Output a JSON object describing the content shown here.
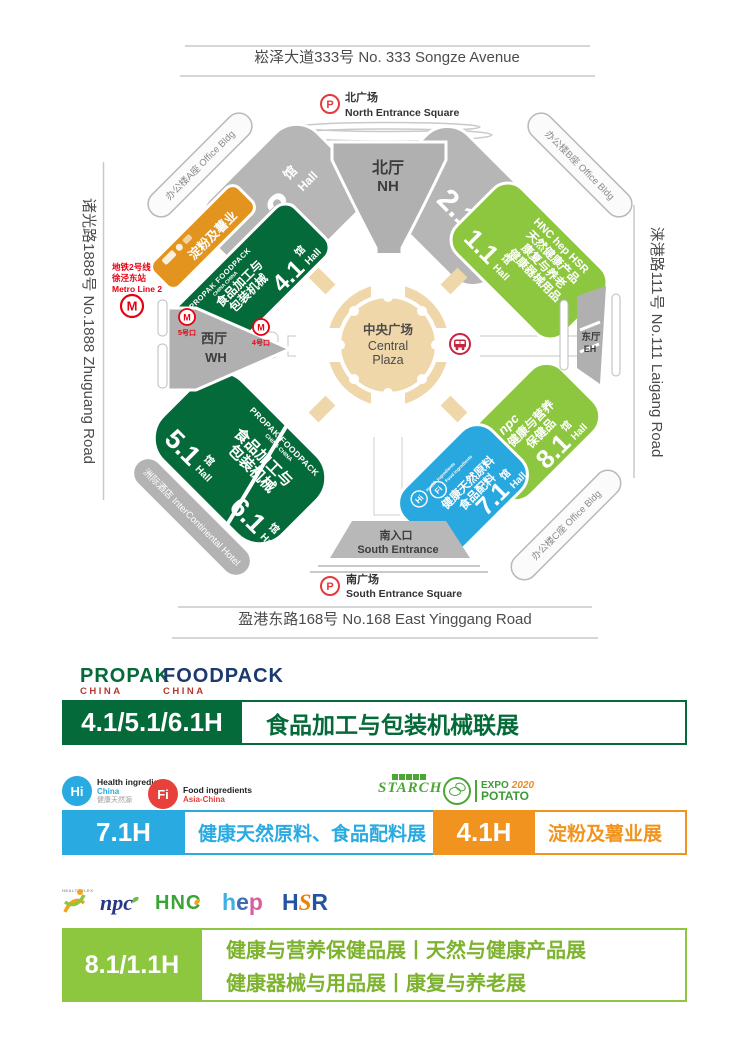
{
  "colors": {
    "dark_green": "#056a39",
    "light_green": "#8dc63f",
    "blue": "#29a8e0",
    "orange_map": "#e2941f",
    "orange_bar": "#f0941f",
    "gray_hall": "#b6b6b6",
    "tan_plaza": "#f0d7a9",
    "metro_red": "#e60012",
    "china_red": "#b5382f",
    "foodpack_navy": "#1d3a6e",
    "bar4_text_green": "#7db32e"
  },
  "roads": {
    "north": "崧泽大道333号  No. 333 Songze Avenue",
    "west": "诸光路1888号  No.1888 Zhuguang Road",
    "east": "涞港路111号  No.111 Laigang Road",
    "south": "盈港东路168号  No.168 East Yinggang Road"
  },
  "p_label": "P",
  "north_square": {
    "cn": "北广场",
    "en": "North Entrance Square"
  },
  "south_entrance": {
    "cn": "南入口",
    "en": "South Entrance"
  },
  "south_square": {
    "cn": "南广场",
    "en": "South Entrance Square"
  },
  "metro": {
    "l1": "地铁2号线",
    "l2": "徐泾东站",
    "l3": "Metro Line 2",
    "m": "M",
    "exit5": "5号口",
    "exit4": "4号口"
  },
  "plaza": {
    "cn": "中央广场",
    "en1": "Central",
    "en2": "Plaza"
  },
  "north_hall": {
    "cn": "北厅",
    "en": "NH"
  },
  "west_hall": {
    "cn": "西厅",
    "en": "WH"
  },
  "east_hall": {
    "cn": "东厅",
    "en": "EH"
  },
  "buildings": {
    "a": "办公楼A座 Office Bldg",
    "b": "办公楼B座 Office Bldg",
    "c": "办公楼C座 Office Bldg",
    "hotel": "洲际酒店 InterContinental Hotel"
  },
  "halls": {
    "h3": {
      "num": "3",
      "guan": "馆",
      "hall": "Hall"
    },
    "h21": {
      "num": "2.1",
      "guan": "馆",
      "hall": "Hall"
    },
    "h41": {
      "num": "4.1",
      "guan": "馆",
      "hall": "Hall",
      "brand": "PROPAK  FOODPACK",
      "brand_sub": "CHINA          CHINA",
      "l1": "食品加工与",
      "l2": "包装机械"
    },
    "h11": {
      "num": "1.1",
      "guan": "馆",
      "hall": "Hall",
      "brand": "HNC hep HSR",
      "l1": "天然健康产品",
      "l2": "康复与养老",
      "l3": "健康器械用品"
    },
    "h51": {
      "num": "5.1",
      "guan": "馆",
      "hall": "Hall"
    },
    "h61": {
      "num": "6.1",
      "guan": "馆",
      "hall": "Hall"
    },
    "sw_brand": {
      "brand": "PROPAK  FOODPACK",
      "brand_sub": "CHINA           CHINA",
      "l1": "食品加工与",
      "l2": "包装机械"
    },
    "h71": {
      "num": "7.1",
      "guan": "馆",
      "hall": "Hall",
      "hi": "Hi",
      "fi": "Fi",
      "hi_t": "Health ingredients",
      "fi_t": "Food ingredients",
      "l1": "健康天然原料",
      "l2": "食品配料"
    },
    "h81": {
      "num": "8.1",
      "guan": "馆",
      "hall": "Hall",
      "brand": "npc",
      "l1": "健康与营养",
      "l2": "保健品"
    },
    "starch_strip": {
      "label": "淀粉及薯业"
    }
  },
  "legend": {
    "propak": {
      "name": "PROPAK",
      "sub": "CHINA"
    },
    "foodpack": {
      "name": "FOODPACK",
      "sub": "CHINA"
    },
    "bar1": {
      "code": "4.1/5.1/6.1H",
      "text": "食品加工与包装机械联展"
    },
    "hi": {
      "abbr": "Hi",
      "l1": "Health ingredients",
      "l2": "China",
      "l3": "健康天然源"
    },
    "fi": {
      "abbr": "Fi",
      "l1": "Food ingredients",
      "l2": "Asia-China"
    },
    "bar2": {
      "code": "7.1H",
      "text": "健康天然原料、食品配料展"
    },
    "starch": {
      "name": "STARCH"
    },
    "expo": {
      "l1": "EXPO",
      "year": "2020",
      "l2": "POTATO"
    },
    "bar3": {
      "code": "4.1H",
      "text": "淀粉及薯业展"
    },
    "healthplex": {
      "name": "HEALTHPLEX"
    },
    "npc": {
      "name": "npc"
    },
    "hnc": {
      "name": "HNC"
    },
    "hep": {
      "c1": "h",
      "c2": "e",
      "c3": "p"
    },
    "hsr": {
      "c1": "H",
      "c2": "S",
      "c3": "R"
    },
    "bar4": {
      "code": "8.1/1.1H",
      "line1": "健康与营养保健品展丨天然与健康产品展",
      "line2": "健康器械与用品展丨康复与养老展"
    }
  }
}
